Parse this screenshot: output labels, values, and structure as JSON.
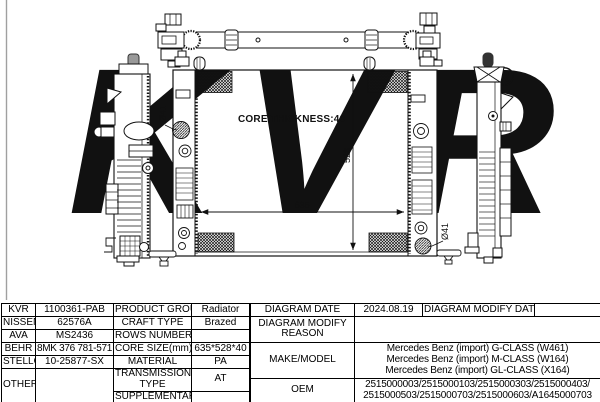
{
  "watermark": {
    "text": "KVR",
    "registered": "®",
    "color": "#ececec"
  },
  "drawing": {
    "labels": {
      "core_thickness": "CORE THICKNESS:40",
      "width_dim": "635",
      "height_dim": "528",
      "left_port_dia": "Ø41",
      "right_port_dia": "Ø41"
    }
  },
  "table": {
    "brands": [
      {
        "name": "KVR",
        "code": "1100361-PAB"
      },
      {
        "name": "NISSENS",
        "code": "62576A"
      },
      {
        "name": "AVA",
        "code": "MS2436"
      },
      {
        "name": "BEHR",
        "code": "8MK 376 781-571"
      },
      {
        "name": "STELLOX",
        "code": "10-25877-SX"
      },
      {
        "name": "OTHERS",
        "code": ""
      }
    ],
    "properties": [
      {
        "label": "PRODUCT GROUP",
        "value": "Radiator"
      },
      {
        "label": "CRAFT TYPE",
        "value": "Brazed"
      },
      {
        "label": "ROWS NUMBER",
        "value": ""
      },
      {
        "label": "CORE SIZE(mm)",
        "value": "635*528*40"
      },
      {
        "label": "MATERIAL",
        "value": "PA"
      },
      {
        "label": "TRANSMISSION TYPE",
        "value": "AT"
      },
      {
        "label": "SUPPLEMENTARY",
        "value": ""
      }
    ],
    "diagram": {
      "date_label": "DIAGRAM DATE",
      "date": "2024.08.19",
      "modify_date_label": "DIAGRAM MODIFY DATE",
      "modify_date": "",
      "modify_reason_label": "DIAGRAM MODIFY REASON",
      "modify_reason": ""
    },
    "make_model": {
      "label": "MAKE/MODEL",
      "models": [
        "Mercedes Benz (import) G-CLASS (W461)",
        "Mercedes Benz (import) M-CLASS (W164)",
        "Mercedes Benz (import) GL-CLASS (X164)"
      ]
    },
    "oem": {
      "label": "OEM",
      "line1": "2515000003/2515000103/2515000303/2515000403/",
      "line2": "2515000503/2515000703/2515000603/A1645000703"
    }
  }
}
